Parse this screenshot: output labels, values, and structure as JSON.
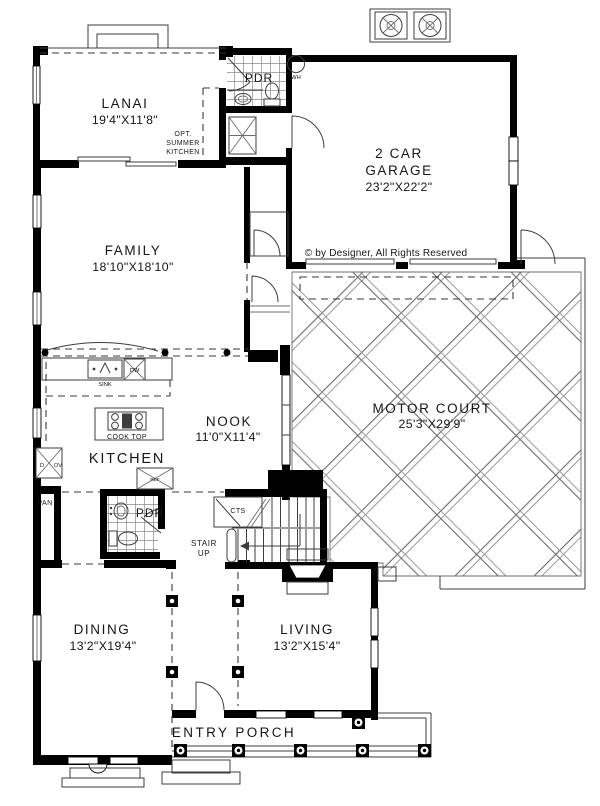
{
  "plan": {
    "copyright": "© by Designer, All Rights Reserved",
    "rooms": {
      "lanai": {
        "name": "LANAI",
        "dims": "19'4\"X11'8\""
      },
      "garage": {
        "line1": "2 CAR",
        "line2": "GARAGE",
        "dims": "23'2\"X22'2\""
      },
      "family": {
        "name": "FAMILY",
        "dims": "18'10\"X18'10\""
      },
      "motor_court": {
        "name": "MOTOR COURT",
        "dims": "25'3\"X29'9\""
      },
      "kitchen": {
        "name": "KITCHEN"
      },
      "nook": {
        "name": "NOOK",
        "dims": "11'0\"X11'4\""
      },
      "dining": {
        "name": "DINING",
        "dims": "13'2\"X19'4\""
      },
      "living": {
        "name": "LIVING",
        "dims": "13'2\"X15'4\""
      },
      "entry_porch": {
        "name": "ENTRY PORCH"
      },
      "pdr_upper": {
        "name": "PDR"
      },
      "pdr_lower": {
        "name": "PDR"
      },
      "stair": {
        "line1": "STAIR",
        "line2": "UP"
      },
      "cts": {
        "name": "CTS"
      },
      "pantry": {
        "name": "PAN"
      }
    },
    "fixtures": {
      "water_heater": "WH",
      "ac": "AC",
      "sink": "SINK",
      "dishwasher": "DW",
      "cook_top": "COOK TOP",
      "refrigerator": "REF",
      "oven_d": "D",
      "oven_ov": "OV",
      "opt_kitchen": [
        "OPT.",
        "SUMMER",
        "KITCHEN"
      ]
    },
    "colors": {
      "wall": "#000000",
      "line": "#444444",
      "background": "#ffffff"
    }
  }
}
